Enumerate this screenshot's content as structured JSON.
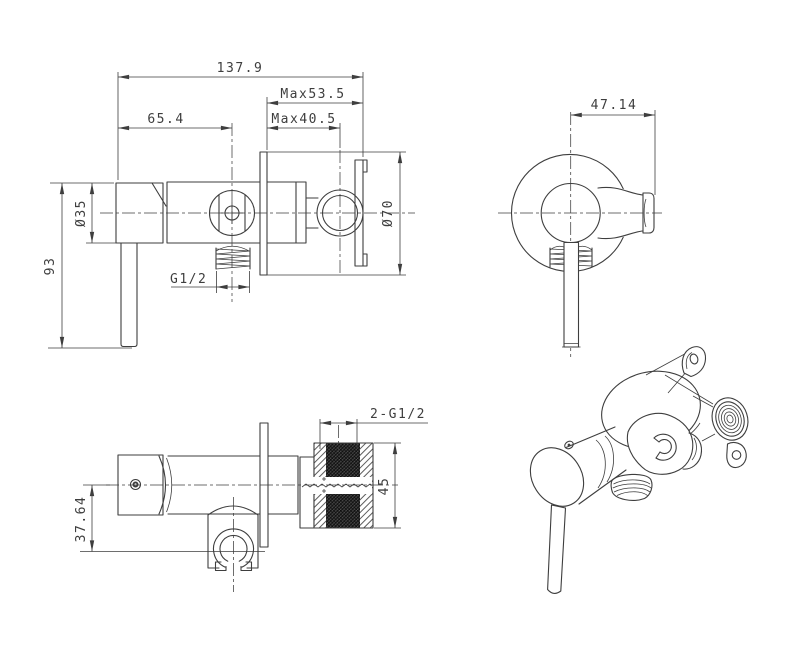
{
  "style": {
    "background": "#ffffff",
    "line_color": "#3e3e3e",
    "knurl_dark": "#1f1f1f"
  },
  "views": {
    "side": {
      "dims": {
        "overall_width": "137.9",
        "max_wall_to_holder": "Max53.5",
        "max_wall_to_center": "Max40.5",
        "handle_face_to_center": "65.4",
        "handle_diameter": "Ø35",
        "lever_length": "93",
        "outlet_thread": "G1/2",
        "plate_diameter": "Ø70"
      }
    },
    "front": {
      "dims": {
        "center_to_holder_tip": "47.14"
      }
    },
    "top": {
      "dims": {
        "inlet_thread": "2-G1/2",
        "union_height": "45",
        "center_to_holder": "37.64"
      }
    },
    "isometric": {
      "dims": {}
    }
  }
}
